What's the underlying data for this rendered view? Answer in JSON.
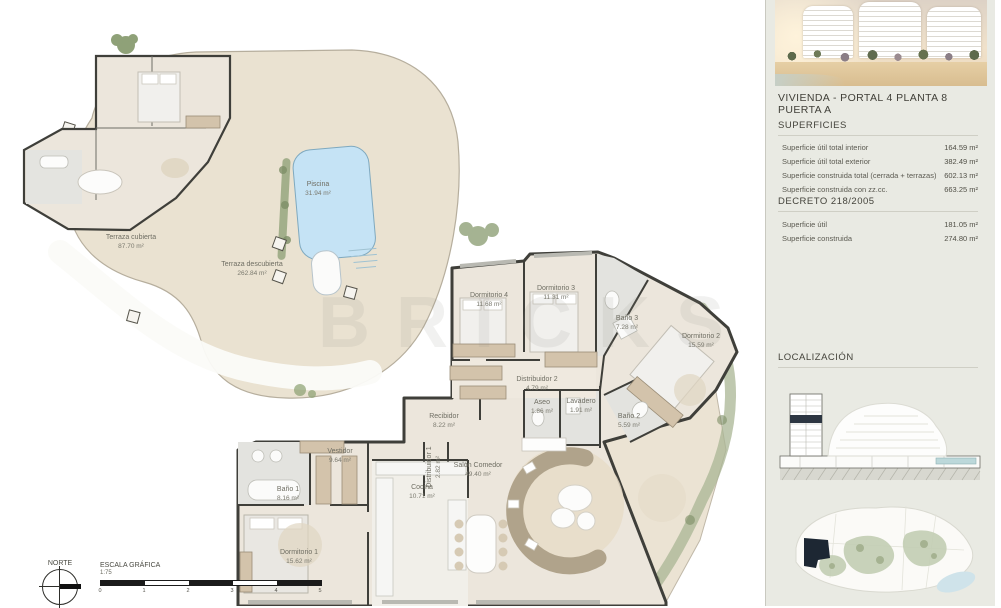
{
  "watermark": "BRICKS",
  "sidebar": {
    "title": "VIVIENDA -  PORTAL 4 PLANTA 8 PUERTA A",
    "superficies": {
      "heading": "SUPERFICIES",
      "rows": [
        {
          "label": "Superficie útil total interior",
          "value": "164.59 m²"
        },
        {
          "label": "Superficie útil total exterior",
          "value": "382.49 m²"
        },
        {
          "label": "Superficie construida total (cerrada + terrazas)",
          "value": "602.13 m²"
        },
        {
          "label": "Superficie construida con zz.cc.",
          "value": "663.25 m²"
        }
      ]
    },
    "decreto": {
      "heading": "DECRETO 218/2005",
      "rows": [
        {
          "label": "Superficie útil",
          "value": "181.05 m²"
        },
        {
          "label": "Superficie construida",
          "value": "274.80 m²"
        }
      ]
    },
    "localizacion": {
      "heading": "LOCALIZACIÓN"
    }
  },
  "plan": {
    "overview": [
      {
        "name": "Piscina",
        "area": "31.94 m²"
      },
      {
        "name": "Terraza cubierta",
        "area": "87.70 m²"
      },
      {
        "name": "Terraza descubierta",
        "area": "262.84 m²"
      }
    ],
    "rooms": [
      {
        "name": "Dormitorio 4",
        "area": "11.68 m²"
      },
      {
        "name": "Dormitorio 3",
        "area": "11.31 m²"
      },
      {
        "name": "Baño 3",
        "area": "7.28 m²"
      },
      {
        "name": "Dormitorio 2",
        "area": "15.59 m²"
      },
      {
        "name": "Distribuidor 2",
        "area": "4.79 m²"
      },
      {
        "name": "Aseo",
        "area": "1.86 m²"
      },
      {
        "name": "Lavadero",
        "area": "1.91 m²"
      },
      {
        "name": "Baño 2",
        "area": "5.59 m²"
      },
      {
        "name": "Recibidor",
        "area": "8.22 m²"
      },
      {
        "name": "Distribuidor 1",
        "area": "2.82 m²"
      },
      {
        "name": "Vestidor",
        "area": "9.64 m²"
      },
      {
        "name": "Baño 1",
        "area": "8.16 m²"
      },
      {
        "name": "Cocina",
        "area": "10.71 m²"
      },
      {
        "name": "Dormitorio 1",
        "area": "15.62 m²"
      },
      {
        "name": "Salón  Comedor",
        "area": "49.40 m²"
      }
    ]
  },
  "footer": {
    "norte_label": "NORTE",
    "escala_label": "ESCALA GRÁFICA",
    "escala_ratio": "1:75",
    "scale_ticks": [
      "0",
      "1",
      "2",
      "3",
      "4",
      "5"
    ]
  }
}
